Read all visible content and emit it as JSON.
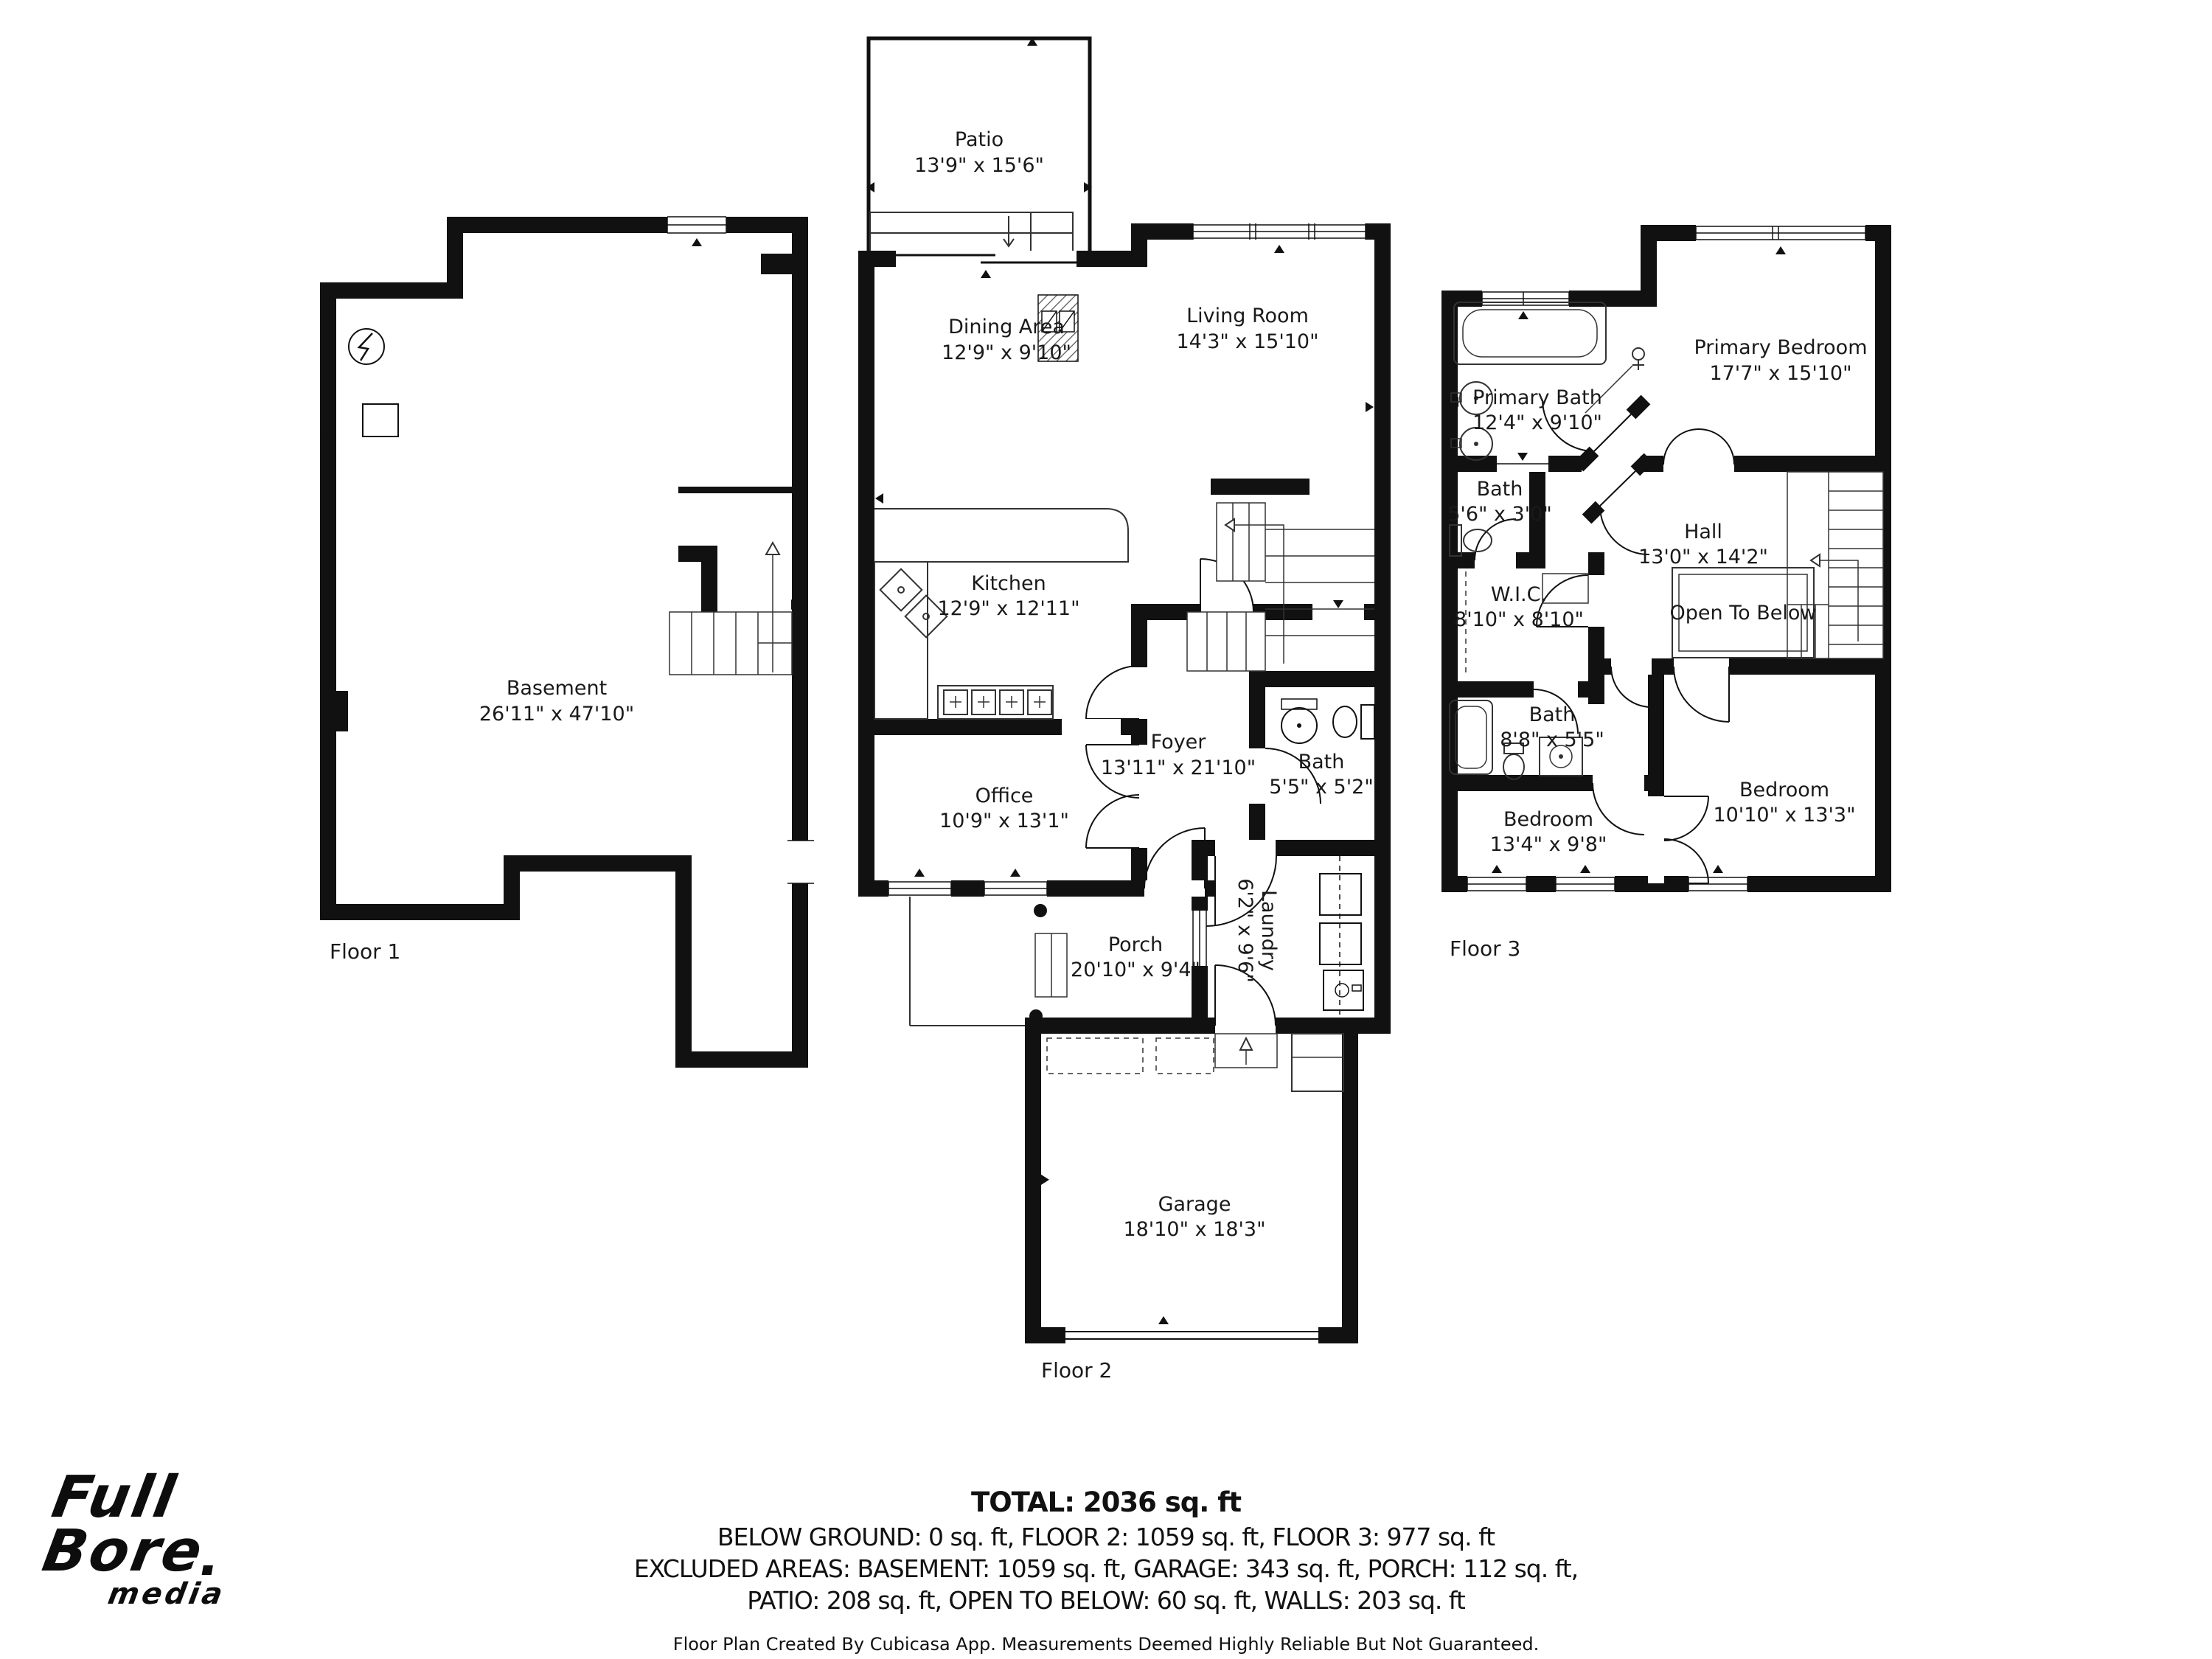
{
  "floors": [
    {
      "label": "Floor 1",
      "rooms": [
        {
          "name": "Basement",
          "dims": "26'11\" x 47'10\""
        }
      ]
    },
    {
      "label": "Floor 2",
      "rooms": [
        {
          "name": "Patio",
          "dims": "13'9\" x 15'6\""
        },
        {
          "name": "Dining Area",
          "dims": "12'9\" x 9'10\""
        },
        {
          "name": "Living Room",
          "dims": "14'3\" x 15'10\""
        },
        {
          "name": "Kitchen",
          "dims": "12'9\" x 12'11\""
        },
        {
          "name": "Foyer",
          "dims": "13'11\" x 21'10\""
        },
        {
          "name": "Bath",
          "dims": "5'5\" x 5'2\""
        },
        {
          "name": "Office",
          "dims": "10'9\" x 13'1\""
        },
        {
          "name": "Porch",
          "dims": "20'10\" x 9'4\""
        },
        {
          "name": "Laundry",
          "dims": "6'2\" x 9'6\""
        },
        {
          "name": "Garage",
          "dims": "18'10\" x 18'3\""
        }
      ]
    },
    {
      "label": "Floor 3",
      "rooms": [
        {
          "name": "Primary Bath",
          "dims": "12'4\" x 9'10\""
        },
        {
          "name": "Primary Bedroom",
          "dims": "17'7\" x 15'10\""
        },
        {
          "name": "Bath",
          "dims": "5'6\" x 3'0\""
        },
        {
          "name": "W.I.C.",
          "dims": "8'10\" x 8'10\""
        },
        {
          "name": "Hall",
          "dims": "13'0\" x 14'2\""
        },
        {
          "name": "Open To Below",
          "dims": ""
        },
        {
          "name": "Bath",
          "dims": "8'8\" x 5'5\""
        },
        {
          "name": "Bedroom",
          "dims": "13'4\" x 9'8\""
        },
        {
          "name": "Bedroom",
          "dims": "10'10\" x 13'3\""
        }
      ]
    }
  ],
  "footer": {
    "total": "TOTAL: 2036 sq. ft",
    "line1": "BELOW GROUND: 0 sq. ft, FLOOR 2: 1059 sq. ft, FLOOR 3: 977 sq. ft",
    "line2": "EXCLUDED AREAS: BASEMENT: 1059 sq. ft, GARAGE: 343 sq. ft, PORCH: 112 sq. ft,",
    "line3": "PATIO: 208 sq. ft, OPEN TO BELOW: 60 sq. ft, WALLS: 203 sq. ft",
    "disclaimer": "Floor Plan Created By Cubicasa App. Measurements Deemed Highly Reliable But Not Guaranteed."
  },
  "logo": {
    "word1": "Full",
    "word2": "Bore",
    "word3": "media"
  }
}
